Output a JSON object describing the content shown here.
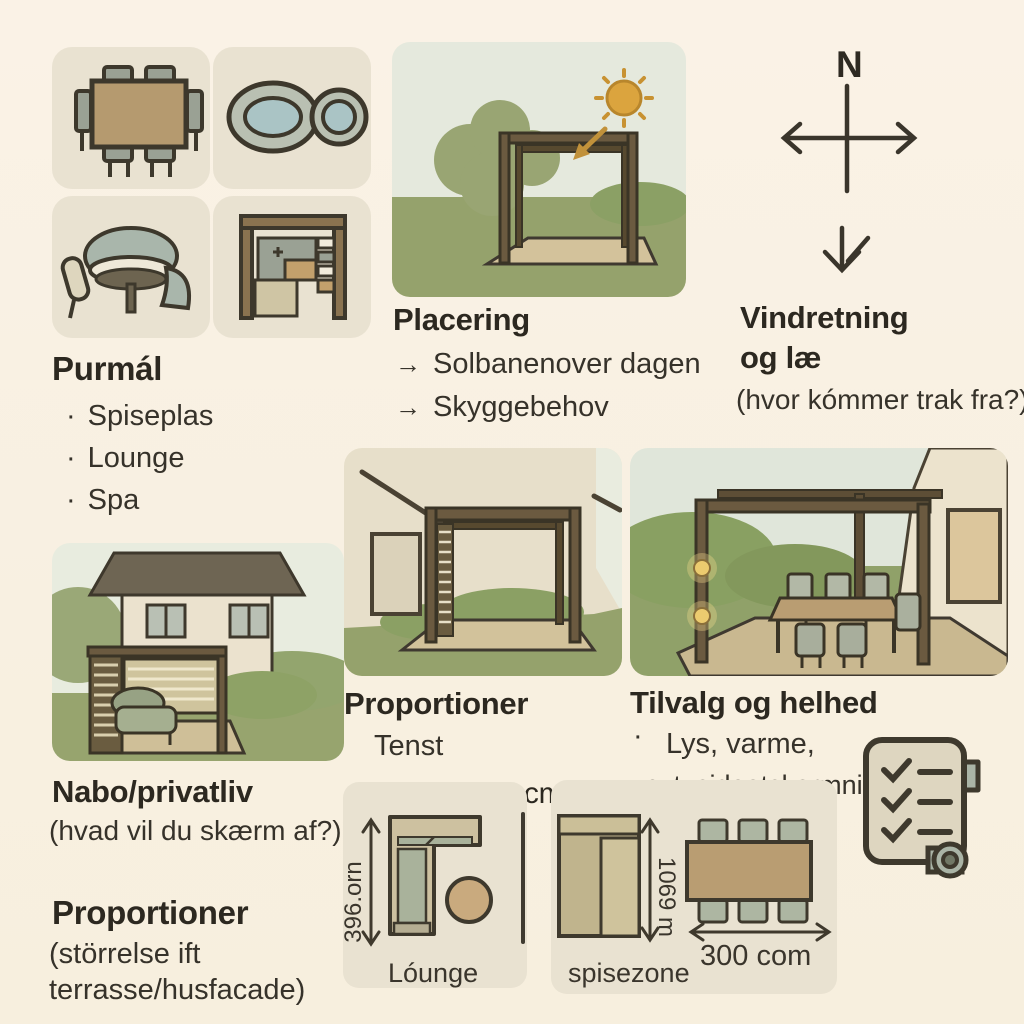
{
  "colors": {
    "background": "#f9f1e3",
    "tile": "#e9e2d1",
    "ink": "#2e2a22",
    "grass": "#95a26c",
    "sky": "#e4e9dd",
    "wood": "#6b5a40",
    "sun": "#d9a43d",
    "plan_panel": "#e9e2d1"
  },
  "purpose": {
    "title": "Purmál",
    "bullet": "·",
    "items": [
      "Spiseplas",
      "Lounge",
      "Spa"
    ],
    "tile_icons": [
      "dining-table-icon",
      "spa-tubs-icon",
      "lounge-table-icon",
      "outdoor-kitchen-icon"
    ]
  },
  "placering": {
    "title": "Placering",
    "arrow": "→",
    "items": [
      "Solbanenover dagen",
      "Skyggebehov"
    ]
  },
  "vindretning": {
    "compass_label": "N",
    "title_line1": "Vindretning",
    "title_line2": "og læ",
    "subtitle": "(hvor kómmer trak fra?)"
  },
  "nabo": {
    "title": "Nabo/privatliv",
    "subtitle": "(hvad vil du skærm af?)"
  },
  "proportioner_center": {
    "title": "Proportioner",
    "note": "Tenst"
  },
  "tilvalg": {
    "title": "Tilvalg og helhed",
    "bullet": "·",
    "line1": "Lys, varme,",
    "line2": "evt. sideatskarmni"
  },
  "proportioner_left": {
    "title": "Proportioner",
    "subtitle_line1": "(störrelse ift",
    "subtitle_line2": "terrasse/husfacade)"
  },
  "plan": {
    "top_width_label": "300 cm",
    "lounge_depth_label": "396.orn",
    "lounge_caption": "Lóunge",
    "spise_depth_label": "1069 m",
    "spise_caption": "spisezone",
    "table_width_label": "300 com"
  }
}
